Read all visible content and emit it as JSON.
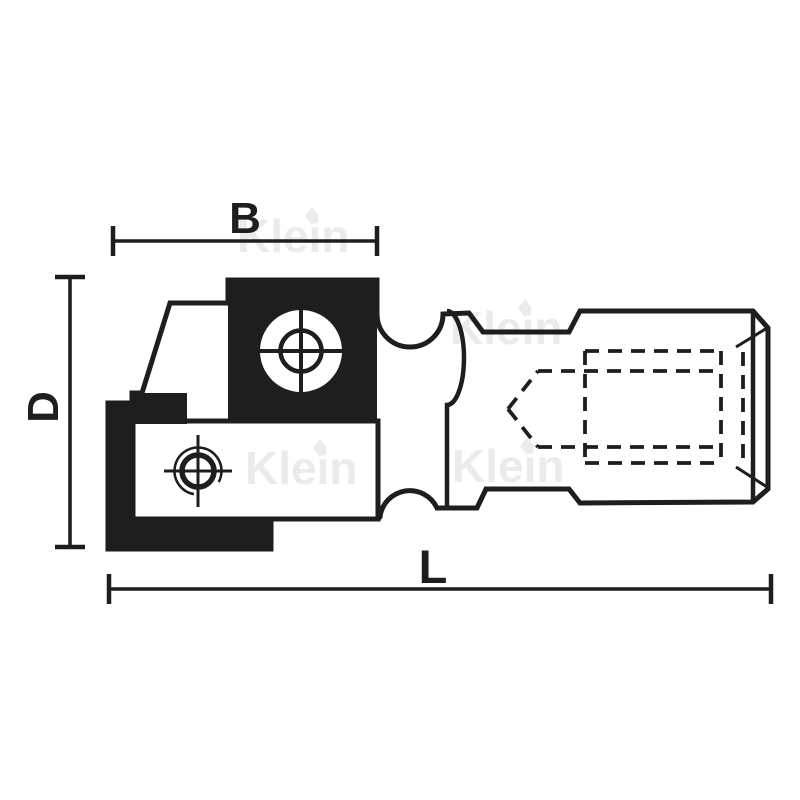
{
  "page": {
    "background_color": "#ffffff",
    "ink_color": "#1e1e1e",
    "description": "Technical line drawing of a cutter head tool with threaded bore, two insert knives and screw crosshairs"
  },
  "dimensions": {
    "width_label": "B",
    "diameter_label": "D",
    "length_label": "L"
  },
  "watermark": {
    "text": "Klein",
    "color": "#ebebeb"
  }
}
